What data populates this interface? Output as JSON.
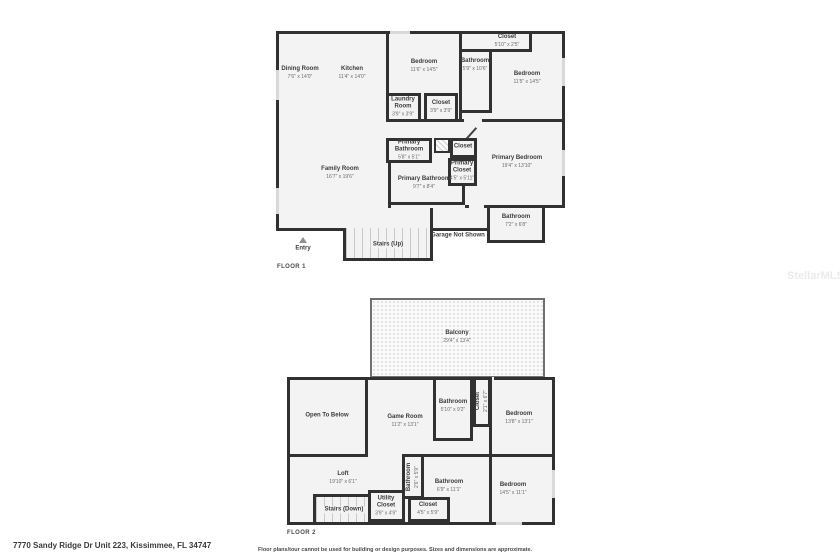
{
  "watermark": "StellarMLS",
  "footer": {
    "address": "7770 Sandy Ridge Dr Unit 223, Kissimmee, FL 34747",
    "disclaimer": "Floor plans/tour cannot be used for building or design purposes. Sizes and dimensions are approximate."
  },
  "colors": {
    "wall": "#313131",
    "room_fill": "#f3f3f3"
  },
  "floor1": {
    "label": "FLOOR 1",
    "annotations": {
      "garage": "Garage Not Shown",
      "stairs": "Stairs (Up)",
      "entry": "Entry"
    },
    "rooms": {
      "dining": {
        "name": "Dining Room",
        "dims": "7'6\" x 14'0\""
      },
      "kitchen": {
        "name": "Kitchen",
        "dims": "11'4\" x 14'0\""
      },
      "bedroom_mid": {
        "name": "Bedroom",
        "dims": "11'6\" x 14'5\""
      },
      "laundry": {
        "name": "Laundry Room",
        "dims": "3'9\" x 3'9\""
      },
      "closet_mid": {
        "name": "Closet",
        "dims": "3'9\" x 3'9\""
      },
      "closet_top": {
        "name": "Closet",
        "dims": "5'10\" x 2'5\""
      },
      "bathroom_top": {
        "name": "Bathroom",
        "dims": "5'9\" x 10'6\""
      },
      "bedroom_right": {
        "name": "Bedroom",
        "dims": "11'5\" x 14'5\""
      },
      "family": {
        "name": "Family Room",
        "dims": "16'7\" x 19'6\""
      },
      "primary_bath_small": {
        "name": "Primary Bathroom",
        "dims": "5'8\" x 5'1\""
      },
      "closet_hall": {
        "name": "Closet"
      },
      "primary_closet": {
        "name": "Primary Closet",
        "dims": "4'5\" x 5'11\""
      },
      "primary_bedroom": {
        "name": "Primary Bedroom",
        "dims": "19'4\" x 13'10\""
      },
      "primary_bath": {
        "name": "Primary Bathroom",
        "dims": "9'7\" x 8'4\""
      },
      "bathroom_br": {
        "name": "Bathroom",
        "dims": "7'2\" x 6'8\""
      }
    }
  },
  "floor2": {
    "label": "FLOOR 2",
    "annotations": {
      "stairs": "Stairs (Down)",
      "open_below": "Open To Below"
    },
    "rooms": {
      "balcony": {
        "name": "Balcony",
        "dims": "29'4\" x 13'4\""
      },
      "game": {
        "name": "Game Room",
        "dims": "11'2\" x 13'1\""
      },
      "bath_a": {
        "name": "Bathroom",
        "dims": "5'10\" x 9'2\""
      },
      "closet_a": {
        "name": "Closet",
        "dims": "2'1\" x 6'7\""
      },
      "bedroom_a": {
        "name": "Bedroom",
        "dims": "13'8\" x 13'1\""
      },
      "loft": {
        "name": "Loft",
        "dims": "19'10\" x 6'1\""
      },
      "bath_b": {
        "name": "Bathroom",
        "dims": "2'6\" x 5'9\""
      },
      "bath_c": {
        "name": "Bathroom",
        "dims": "6'9\" x 11'1\""
      },
      "utility": {
        "name": "Utility Closet",
        "dims": "3'9\" x 4'9\""
      },
      "closet_b": {
        "name": "Closet",
        "dims": "4'5\" x 5'9\""
      },
      "bedroom_b": {
        "name": "Bedroom",
        "dims": "14'5\" x 11'1\""
      }
    }
  }
}
